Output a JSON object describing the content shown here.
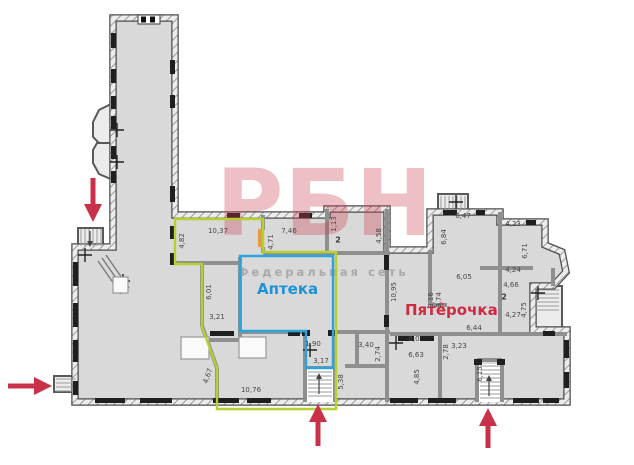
{
  "document": {
    "type": "floor-plan"
  },
  "watermark": {
    "brand": "РБН",
    "tagline": "Федеральная сеть"
  },
  "tenants": {
    "pharmacy": {
      "label": "Аптека"
    },
    "store": {
      "label": "Пятёрочка"
    }
  },
  "room_numbers": [
    {
      "text": "2",
      "x": 338,
      "y": 240
    },
    {
      "text": "2",
      "x": 504,
      "y": 297
    }
  ],
  "dimension_labels": [
    {
      "t": "10,37",
      "x": 218,
      "y": 231,
      "r": 0
    },
    {
      "t": "4,82",
      "x": 182,
      "y": 241,
      "r": -90
    },
    {
      "t": "7,46",
      "x": 289,
      "y": 231,
      "r": 0
    },
    {
      "t": "4,71",
      "x": 271,
      "y": 242,
      "r": -90
    },
    {
      "t": "1,13",
      "x": 334,
      "y": 224,
      "r": -90
    },
    {
      "t": "4,58",
      "x": 379,
      "y": 236,
      "r": -90
    },
    {
      "t": "6,01",
      "x": 209,
      "y": 292,
      "r": -90
    },
    {
      "t": "3,21",
      "x": 217,
      "y": 317,
      "r": 0
    },
    {
      "t": "1,90",
      "x": 313,
      "y": 344,
      "r": 0
    },
    {
      "t": "3,17",
      "x": 321,
      "y": 361,
      "r": 0
    },
    {
      "t": "5,38",
      "x": 341,
      "y": 382,
      "r": -90
    },
    {
      "t": "10,76",
      "x": 251,
      "y": 390,
      "r": 0
    },
    {
      "t": "4,67",
      "x": 208,
      "y": 376,
      "r": -70
    },
    {
      "t": "3,40",
      "x": 366,
      "y": 345,
      "r": 0
    },
    {
      "t": "2,74",
      "x": 378,
      "y": 354,
      "r": -90
    },
    {
      "t": "10,95",
      "x": 394,
      "y": 292,
      "r": -90
    },
    {
      "t": "6,47",
      "x": 463,
      "y": 216,
      "r": 0
    },
    {
      "t": "6,84",
      "x": 444,
      "y": 237,
      "r": -90
    },
    {
      "t": "4,23",
      "x": 513,
      "y": 224,
      "r": 0
    },
    {
      "t": "6,71",
      "x": 525,
      "y": 251,
      "r": -90
    },
    {
      "t": "4,24",
      "x": 513,
      "y": 270,
      "r": 0
    },
    {
      "t": "6,05",
      "x": 464,
      "y": 277,
      "r": 0
    },
    {
      "t": "4,66",
      "x": 511,
      "y": 285,
      "r": 0
    },
    {
      "t": "4,75",
      "x": 524,
      "y": 310,
      "r": -90
    },
    {
      "t": "4,27",
      "x": 513,
      "y": 315,
      "r": 0
    },
    {
      "t": "3,16",
      "x": 431,
      "y": 300,
      "r": -90
    },
    {
      "t": "3,74",
      "x": 439,
      "y": 300,
      "r": -90
    },
    {
      "t": "6,44",
      "x": 474,
      "y": 328,
      "r": 0
    },
    {
      "t": "6,0",
      "x": 414,
      "y": 339,
      "r": 0
    },
    {
      "t": "6,63",
      "x": 416,
      "y": 355,
      "r": 0
    },
    {
      "t": "3,23",
      "x": 459,
      "y": 346,
      "r": 0
    },
    {
      "t": "2,78",
      "x": 446,
      "y": 352,
      "r": -90
    },
    {
      "t": "4,85",
      "x": 417,
      "y": 377,
      "r": -90
    },
    {
      "t": "6,15",
      "x": 480,
      "y": 374,
      "r": -90
    }
  ],
  "entrances": [
    {
      "id": "north-west-entrance",
      "arrow": "down"
    },
    {
      "id": "west-entrance",
      "arrow": "right"
    },
    {
      "id": "south-center-entrance",
      "arrow": "up"
    },
    {
      "id": "south-east-entrance",
      "arrow": "up"
    }
  ],
  "colors": {
    "floor_fill": "#d9d9d9",
    "wall": "#4d4d4d",
    "window": "#1f1f1f",
    "lease_outline": "#b5d02f",
    "pharmacy_outline": "#2aa3de",
    "pharmacy_text": "#1b93d6",
    "store_text": "#cf2a40",
    "arrow": "#c93049",
    "door_highlight": "#e39c3c",
    "watermark_red": "rgba(203,64,78,0.33)",
    "watermark_gray": "rgba(158,156,160,0.8)",
    "dimension_text": "#474747"
  }
}
